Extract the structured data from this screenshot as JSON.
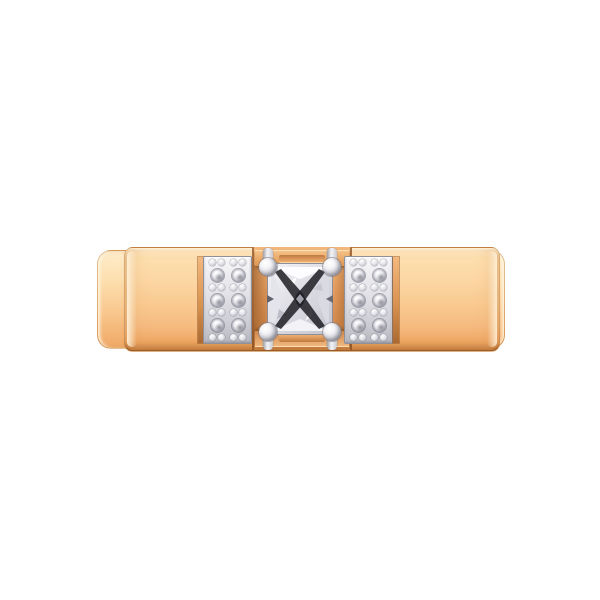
{
  "scene": {
    "type": "product-photo",
    "subject": "Rose gold flat ring band viewed from the front with a prong-set princess-cut center diamond and two white-gold pave diamond panels",
    "background": "#ffffff"
  },
  "colors": {
    "bg": "#ffffff",
    "gold_highlight": "#ffeccb",
    "gold_light": "#fddfaf",
    "gold_mid": "#f9c88f",
    "gold_deep": "#efa865",
    "gold_edge": "#cf8a49",
    "rose_light": "#f4b97e",
    "rose_mid": "#e2985a",
    "rose_deep": "#c57c3f",
    "metal_light": "#f4f4f7",
    "metal_mid": "#cdcdd5",
    "metal_dark": "#8f8f99",
    "diamond_x": "#1d1d23"
  },
  "ring": {
    "band_material": "rose-gold",
    "setting_material": "white-metal",
    "center_stone": {
      "cut": "princess",
      "count": 1,
      "prong_count": 4
    },
    "pave_panels": [
      {
        "side": "left",
        "columns": 2,
        "stones_per_column": 3,
        "bead_rows_per_column": 4
      },
      {
        "side": "right",
        "columns": 2,
        "stones_per_column": 3,
        "bead_rows_per_column": 4
      }
    ],
    "side_stone_total": 12
  }
}
